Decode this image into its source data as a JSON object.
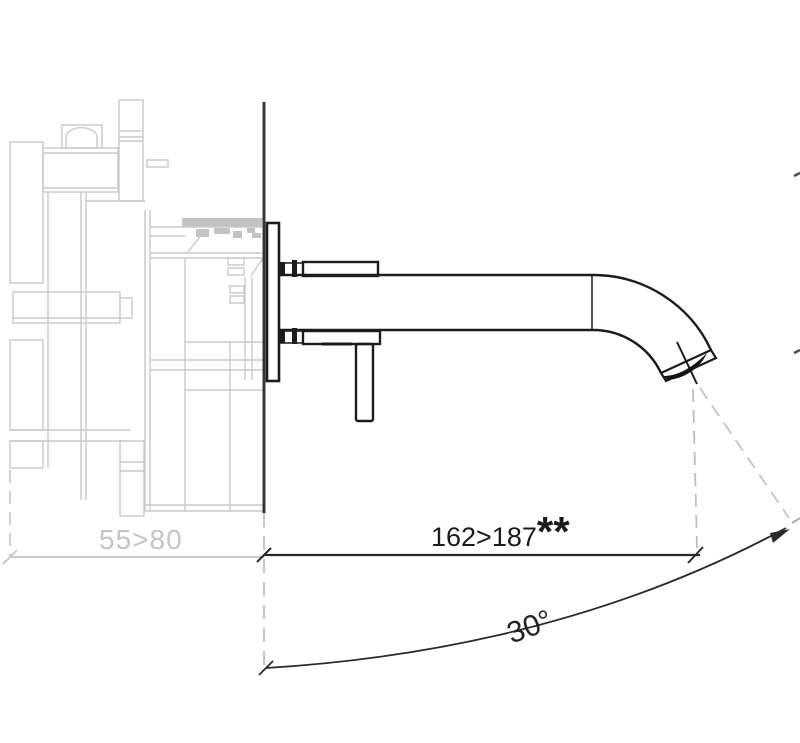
{
  "drawing": {
    "background": "#ffffff",
    "line_color": "#1c1c1c",
    "ghost_color": "#c9c9c9",
    "accent_dark": "#2a2a2a"
  },
  "annotations": {
    "depth": {
      "value": "55>80"
    },
    "projection": {
      "value": "162>187",
      "note": "**"
    },
    "angle": {
      "value": "30°"
    }
  }
}
